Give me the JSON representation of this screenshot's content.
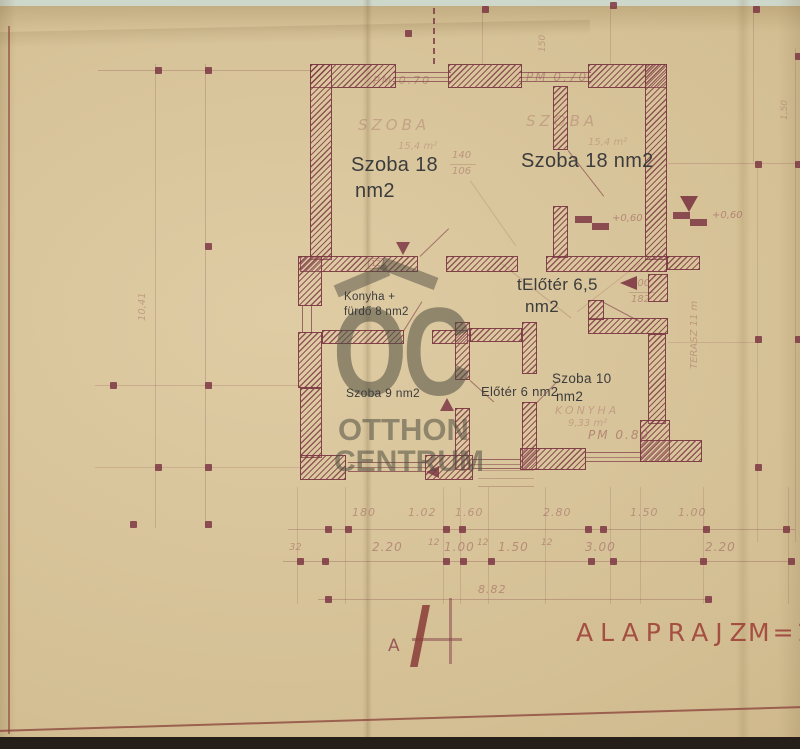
{
  "watermark": {
    "oc": "OC",
    "otthon": "OTTHON",
    "centrum": "CENTRUM"
  },
  "labels": {
    "room1": {
      "l1": "Szoba 18",
      "l2": "nm2"
    },
    "room2": "Szoba 18 nm2",
    "hall_top": {
      "l1": "tElőtér 6,5",
      "l2": "nm2"
    },
    "kitchen": {
      "l1": "Konyha +",
      "l2": "fürdő  8 nm2"
    },
    "room3": "Szoba 9 nm2",
    "hall_bottom": "Előtér 6 nm2",
    "room4": {
      "l1": "Szoba 10",
      "l2": "nm2"
    }
  },
  "ann": {
    "pm070_left": "PM 0.70",
    "pm070_right": "PM 0.70",
    "pm080": "PM 0.80",
    "szoba_left": "SZOBA",
    "szoba_right": "SZOBA",
    "area_left": "15,4 m²",
    "area_right": "15,4 m²",
    "plus060_a": "+0,60",
    "plus060_b": "+0,60",
    "door_a_w": "140",
    "door_a_h": "106",
    "door_b_w": "100",
    "door_b_h": "182",
    "box12": "12",
    "terasz": "TERASZ 11 m",
    "konyha": "KONYHA",
    "konyha_area": "9,33 m²",
    "v150": "150",
    "v1041": "10,41",
    "v150r": "1,50"
  },
  "dims": {
    "row1": [
      "180",
      "1.02",
      "1.60",
      "2.80",
      "1.50",
      "1.00"
    ],
    "row2": [
      "32",
      "2.20",
      "12",
      "1.00",
      "12",
      "1.50",
      "12",
      "3.00",
      "2.20"
    ],
    "total": "8.82"
  },
  "footer": {
    "section": "A",
    "title": "ALAPRAJZ",
    "scale": "M=1"
  },
  "colors": {
    "paper": "#d6c196",
    "ink": "#7c3743",
    "overlay_text": "#3c3c3c",
    "watermark": "#514e42",
    "title_ink": "#9e4238",
    "top_strip": "#cdd7ca",
    "bottom_strip": "#251e19"
  }
}
